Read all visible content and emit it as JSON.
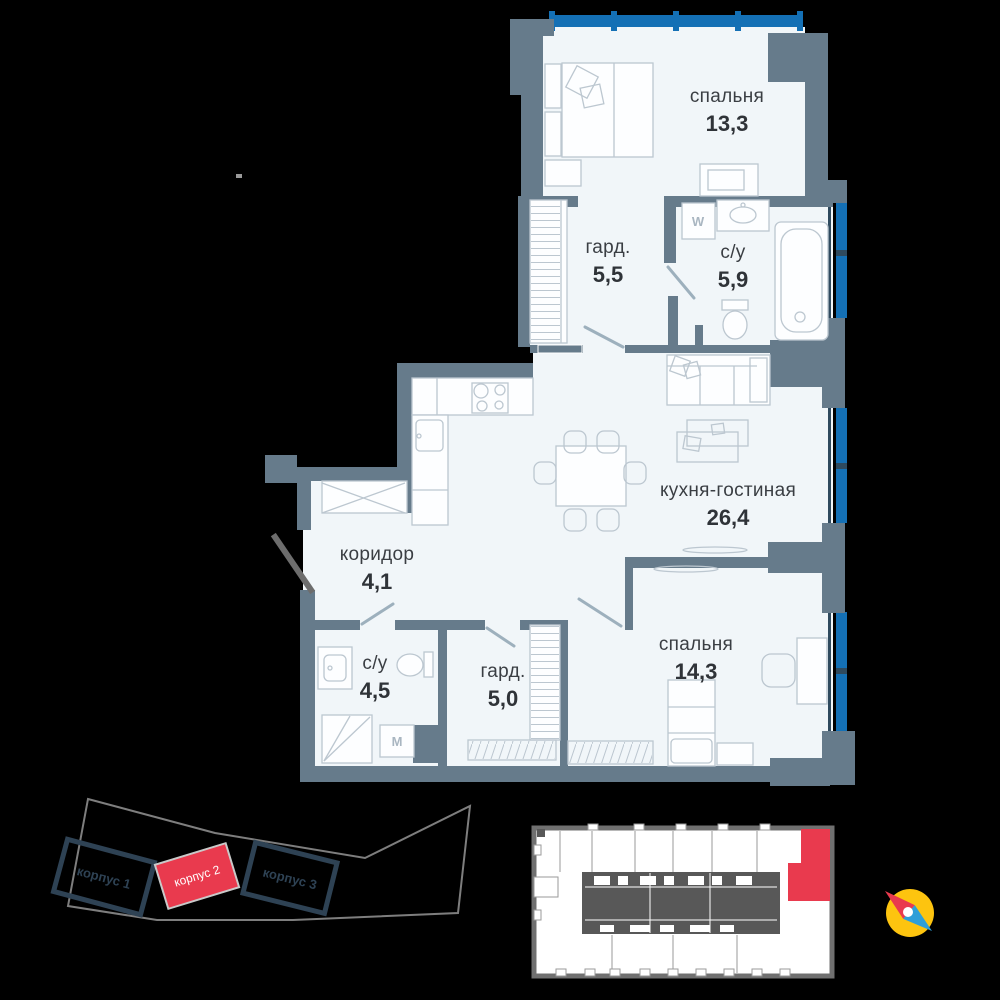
{
  "colors": {
    "bg": "#000000",
    "wall": "#667b8b",
    "room": "#f1f6f9",
    "furniture": "#bcc7d0",
    "window": "#1470b5",
    "window-frame": "#2f4a5e",
    "accent-red": "#e93a4e",
    "building-outline": "#2e4254",
    "site-outline": "#7e7e7e",
    "mini-outline": "#707070",
    "mini-core": "#585858",
    "compass-yellow": "#fdc40f",
    "compass-blue": "#2e9fd8",
    "label-text": "#3a3e43",
    "door": "#9db0bd",
    "entrance-door": "#6d6d6d"
  },
  "plan": {
    "rooms": [
      {
        "id": "bedroom-1",
        "name": "спальня",
        "area": "13,3"
      },
      {
        "id": "wardrobe-1",
        "name": "гард.",
        "area": "5,5"
      },
      {
        "id": "bathroom-1",
        "name": "с/у",
        "area": "5,9"
      },
      {
        "id": "kitchen-living",
        "name": "кухня-гостиная",
        "area": "26,4"
      },
      {
        "id": "corridor",
        "name": "коридор",
        "area": "4,1"
      },
      {
        "id": "bathroom-2",
        "name": "с/у",
        "area": "4,5"
      },
      {
        "id": "wardrobe-2",
        "name": "гард.",
        "area": "5,0"
      },
      {
        "id": "bedroom-2",
        "name": "спальня",
        "area": "14,3"
      }
    ],
    "appliances": {
      "washer_label": "W",
      "washer2_label": "M"
    }
  },
  "site_plan": {
    "buildings": [
      {
        "label": "корпус 1",
        "highlighted": false
      },
      {
        "label": "корпус 2",
        "highlighted": true
      },
      {
        "label": "корпус 3",
        "highlighted": false
      }
    ]
  }
}
